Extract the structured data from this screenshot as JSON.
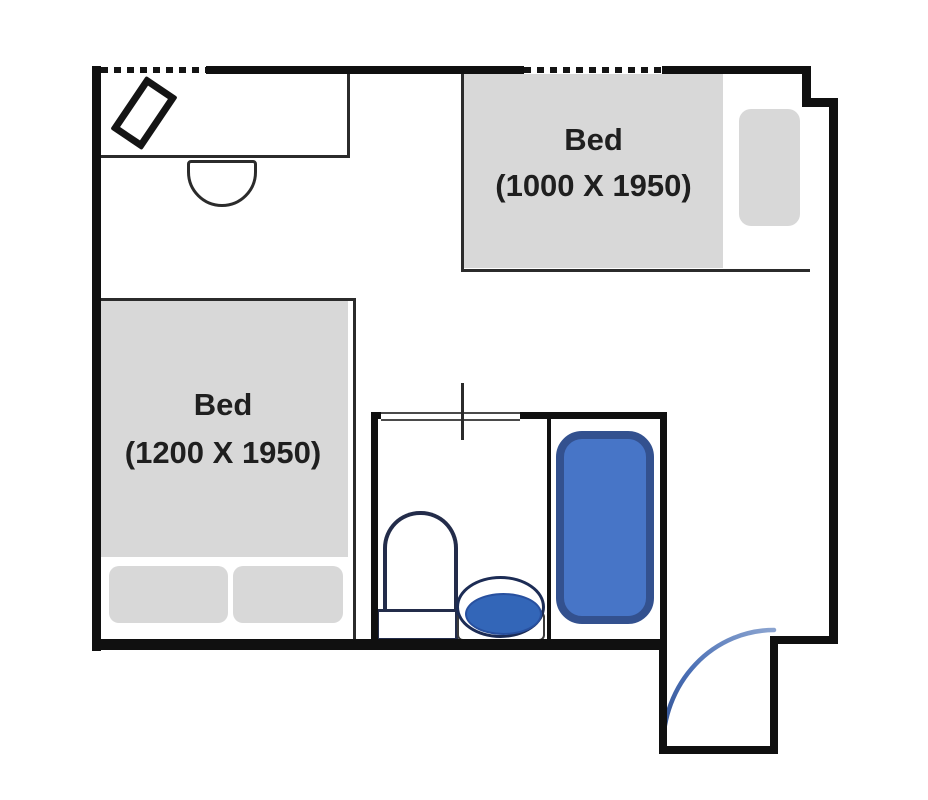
{
  "title": "Room floor plan",
  "beds": [
    {
      "label": "Bed",
      "dimensions": "(1200 X 1950)"
    },
    {
      "label": "Bed",
      "dimensions": "(1000 X 1950)"
    }
  ],
  "fixtures": {
    "desk": "desk",
    "chair": "desk-chair",
    "laptop": "laptop",
    "toilet": "toilet",
    "sink": "sink",
    "bathtub": "bathtub",
    "entry_door": "entry-door-swing"
  },
  "windows": {
    "count": 2,
    "style": "dashed-wall-opening"
  },
  "colors": {
    "wall": "#101010",
    "furniture_gray": "#d8d8d8",
    "fixture_blue_fill": "#4775c7",
    "fixture_blue_border": "#33518f",
    "sink_blue_fill": "#3366b8",
    "door_arc_blue": "#4a6fb5",
    "line_dark": "#2b2b2b",
    "text": "#1f1f1f"
  }
}
